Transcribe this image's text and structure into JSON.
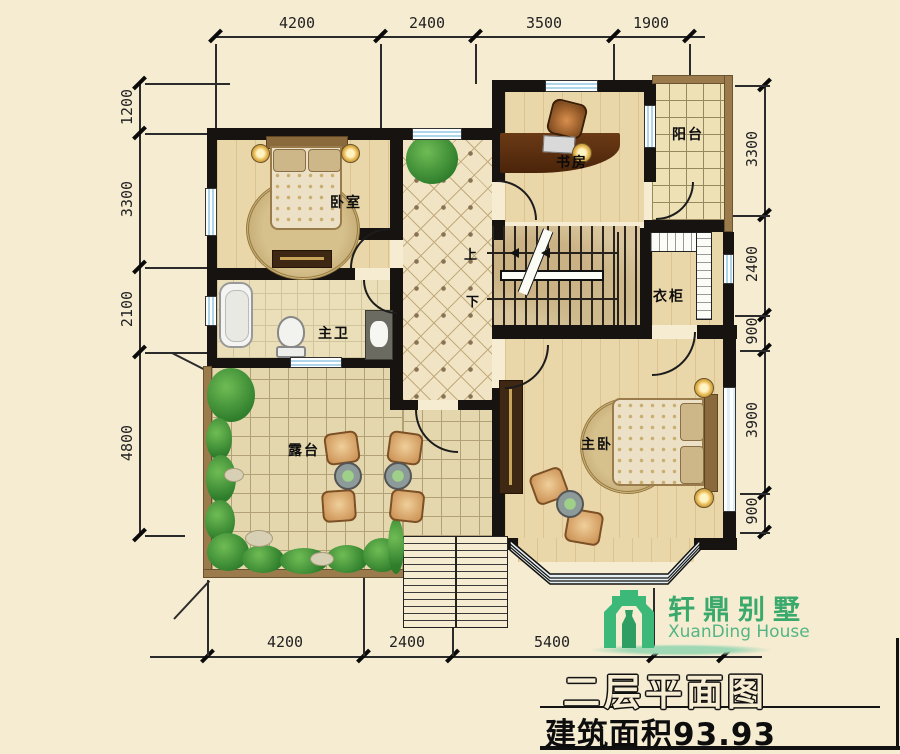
{
  "plan_title": "二层平面图",
  "area_note": "建筑面积93.93",
  "logo": {
    "brand": "轩鼎别墅",
    "subtitle": "XuanDing House"
  },
  "rooms": {
    "bedroom": "卧室",
    "study": "书房",
    "balcony": "阳台",
    "closet": "衣柜",
    "bathroom": "主卫",
    "terrace": "露台",
    "master_bedroom": "主卧"
  },
  "stairs": {
    "up": "上",
    "down": "下"
  },
  "dimensions": {
    "top": [
      "4200",
      "2400",
      "3500",
      "1900"
    ],
    "left": [
      "1200",
      "3300",
      "2100",
      "4800"
    ],
    "right": [
      "3300",
      "2400",
      "900",
      "3900",
      "900"
    ],
    "bottom": [
      "4200",
      "2400",
      "5400"
    ]
  },
  "colors": {
    "background": "#f6ecd2",
    "wall": "#171310",
    "railing": "#9b7b4c",
    "window_blue": "#aed5ea",
    "logo_green": "#3cb878"
  }
}
